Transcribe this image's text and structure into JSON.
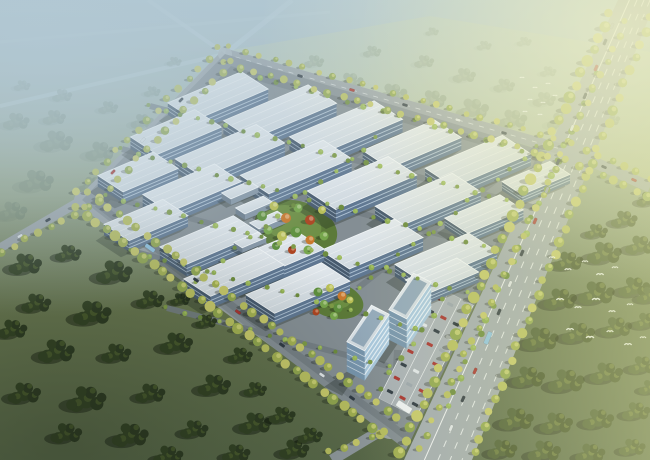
{
  "meta": {
    "title": "Industrial park aerial rendering",
    "description": "Bird's-eye architectural rendering: diamond-shaped industrial campus of white flat-roofed factory halls with blue-grey glass facades, central landscaped garden with orange and yellow accent trees, small warehouse sheds, two glass office towers beside a car park, tree-lined perimeter avenues with traffic, hazy blue mist upper-left, warm sunlit fields upper-right, dark green forests and grassland below, white birds flying over the woods.",
    "visible_text": "none"
  },
  "palette": {
    "mist": "#b2c7d3",
    "sky_warm": "#e9ebc8",
    "grass_dark": "#5c6b4a",
    "grass_mid": "#6d7c52",
    "grass_warm": "#8a9458",
    "forest_dark": "#2c3a22",
    "forest_mid": "#324224",
    "forest_hi": "#4b5e2e",
    "forest_warm": "#3f4e28",
    "forest_warm2": "#485932",
    "forest_warm_hi": "#6a793c",
    "haze_tree_a": "#7d8d66",
    "haze_tree_b": "#879471",
    "haze_tree_hi": "#9aa57d",
    "dist_tree_a": "#657763",
    "dist_tree_b": "#6e8069",
    "dist_tree_hi": "#7e8f74",
    "road": "#9aa3a8",
    "road_main": "#a2abb0",
    "road_inner": "#747e84",
    "marking": "#f4f8fa",
    "roof_light": "#eef2f5",
    "roof_shade": "#cbd5dc",
    "facade_long": "#5f7792",
    "facade_end": "#475a6e",
    "facade_stripe": "rgba(206,223,237,0.85)",
    "shed_long": "#8495a5",
    "shed_end": "#6b7c8c",
    "glass_long": "#a9c8de",
    "glass_end": "#7795ad",
    "glass_stripe": "rgba(246,251,253,0.9)",
    "tower_panel": "#93a9ba",
    "street_trees": [
      "#b8bf60",
      "#a2b052",
      "#c6c86a",
      "#90a64f"
    ],
    "street_tree_hi": "#d4d87e",
    "campus_trees": [
      "#7d9a46",
      "#8fae52",
      "#6d8c3e",
      "#9ab85a"
    ],
    "campus_tree_hi": "#a9c468",
    "garden": {
      "g1": "#5d8f3c",
      "g2": "#76a64c",
      "y": "#b9bf55",
      "o": "#c9792e",
      "r": "#ad4420",
      "base": "#5c7a39",
      "base_hi": "#76994a"
    },
    "car": {
      "red": "#a83430",
      "dark": "#2f3a44",
      "white": "#dfe5e9",
      "silver": "#9aa4ac",
      "bus": "#8fc3e2"
    },
    "shadow": "rgba(24,33,27,0.30)",
    "tree_shadow": "rgba(16,24,12,0.30)"
  },
  "scene": {
    "factories": [
      [
        218,
        96,
        80,
        32,
        12
      ],
      [
        280,
        112,
        92,
        34,
        13
      ],
      [
        346,
        128,
        92,
        34,
        13
      ],
      [
        412,
        144,
        78,
        32,
        12
      ],
      [
        478,
        161,
        84,
        34,
        12
      ],
      [
        536,
        178,
        52,
        24,
        9
      ],
      [
        176,
        132,
        70,
        32,
        12
      ],
      [
        230,
        151,
        88,
        34,
        13
      ],
      [
        296,
        167,
        90,
        34,
        13
      ],
      [
        362,
        183,
        88,
        34,
        13
      ],
      [
        428,
        199,
        84,
        34,
        12
      ],
      [
        484,
        214,
        60,
        28,
        10
      ],
      [
        138,
        172,
        60,
        30,
        11
      ],
      [
        192,
        188,
        78,
        32,
        12
      ],
      [
        372,
        244,
        80,
        34,
        13
      ],
      [
        446,
        258,
        80,
        34,
        12
      ],
      [
        146,
        220,
        64,
        30,
        11
      ],
      [
        210,
        240,
        80,
        32,
        12
      ],
      [
        274,
        256,
        80,
        32,
        12
      ],
      [
        442,
        276,
        56,
        26,
        10
      ],
      [
        234,
        272,
        80,
        32,
        12
      ],
      [
        298,
        288,
        82,
        34,
        12
      ]
    ],
    "sheds": [
      [
        240,
        190,
        30,
        11,
        6
      ],
      [
        254,
        205,
        30,
        11,
        6
      ],
      [
        268,
        220,
        30,
        11,
        6
      ],
      [
        250,
        240,
        26,
        10,
        5
      ]
    ],
    "towers": [
      [
        368,
        328,
        44,
        20,
        30
      ],
      [
        410,
        296,
        44,
        20,
        30
      ]
    ],
    "garden_trees": [
      [
        262,
        216,
        "g1",
        5
      ],
      [
        274,
        206,
        "y",
        4.5
      ],
      [
        286,
        218,
        "o",
        5
      ],
      [
        298,
        208,
        "g2",
        4.5
      ],
      [
        310,
        220,
        "r",
        5
      ],
      [
        322,
        210,
        "y",
        4
      ],
      [
        268,
        230,
        "g2",
        4.5
      ],
      [
        282,
        236,
        "y",
        5
      ],
      [
        296,
        232,
        "g1",
        5.5
      ],
      [
        310,
        240,
        "o",
        4.5
      ],
      [
        324,
        236,
        "g2",
        4.5
      ],
      [
        276,
        246,
        "g1",
        4
      ],
      [
        292,
        250,
        "r",
        4
      ],
      [
        308,
        250,
        "g2",
        4.5
      ],
      [
        318,
        292,
        "g1",
        4.5
      ],
      [
        330,
        288,
        "y",
        4
      ],
      [
        342,
        296,
        "o",
        4.5
      ],
      [
        324,
        304,
        "g2",
        4
      ],
      [
        338,
        308,
        "g1",
        4.5
      ],
      [
        350,
        300,
        "y",
        3.5
      ],
      [
        316,
        312,
        "r",
        3.5
      ],
      [
        334,
        316,
        "g2",
        4
      ]
    ],
    "parking": {
      "origin": [
        436,
        286
      ],
      "angle_row": 27,
      "angle_aisle": 117,
      "width": 42,
      "length": 126,
      "rows": 3,
      "row_step": 14,
      "cols": 8,
      "col_step": 15,
      "car_size": [
        6.4,
        3.1
      ],
      "car_colors": [
        "red",
        "dark",
        "white",
        "silver",
        "red",
        "dark"
      ]
    },
    "tree_rows_street": [
      [
        610,
        14,
        400,
        452,
        13,
        4.2,
        6.2
      ],
      [
        626,
        22,
        420,
        448,
        15,
        3.0,
        4.0
      ],
      [
        651,
        18,
        474,
        452,
        14,
        3.8,
        5.4
      ],
      [
        230,
        47,
        569,
        142,
        15,
        2.6,
        3.6
      ],
      [
        225,
        63,
        563,
        160,
        15,
        3.0,
        4.2
      ],
      [
        219,
        48,
        76,
        192,
        14,
        3.0,
        4.2
      ],
      [
        232,
        62,
        90,
        208,
        14,
        3.2,
        4.4
      ],
      [
        77,
        208,
        381,
        434,
        12,
        4.0,
        5.8
      ],
      [
        89,
        193,
        397,
        417,
        12,
        3.6,
        5.0
      ],
      [
        86,
        208,
        2,
        252,
        13,
        3.2,
        4.4
      ],
      [
        573,
        144,
        650,
        178,
        13,
        3.2,
        4.4
      ],
      [
        567,
        160,
        648,
        196,
        13,
        3.4,
        4.8
      ],
      [
        330,
        452,
        384,
        432,
        14,
        3.2,
        4.2
      ]
    ],
    "tree_rows_campus": [
      [
        150,
        106,
        536,
        208,
        16,
        2.0,
        3.0
      ],
      [
        122,
        149,
        498,
        250,
        16,
        2.0,
        3.0
      ],
      [
        107,
        196,
        466,
        292,
        16,
        2.0,
        3.0
      ],
      [
        132,
        251,
        416,
        328,
        17,
        2.0,
        2.8
      ],
      [
        167,
        308,
        388,
        366,
        17,
        2.0,
        2.8
      ],
      [
        377,
        138,
        194,
        282,
        18,
        2.0,
        2.8
      ],
      [
        538,
        147,
        358,
        288,
        18,
        2.0,
        2.8
      ],
      [
        598,
        74,
        447,
        406,
        16,
        2.6,
        3.8
      ],
      [
        242,
        72,
        556,
        160,
        18,
        2.2,
        3.2
      ],
      [
        444,
        300,
        380,
        388,
        18,
        2.4,
        3.2
      ]
    ],
    "forest_bottom_left": [
      [
        25,
        265,
        1
      ],
      [
        68,
        254,
        0.8
      ],
      [
        114,
        273,
        1.1
      ],
      [
        36,
        304,
        0.9
      ],
      [
        92,
        314,
        1.15
      ],
      [
        150,
        300,
        0.85
      ],
      [
        56,
        352,
        1.1
      ],
      [
        116,
        354,
        0.9
      ],
      [
        176,
        344,
        1
      ],
      [
        24,
        394,
        1
      ],
      [
        86,
        400,
        1.2
      ],
      [
        150,
        394,
        0.9
      ],
      [
        214,
        386,
        1
      ],
      [
        66,
        434,
        0.95
      ],
      [
        130,
        436,
        1.1
      ],
      [
        194,
        430,
        0.85
      ],
      [
        255,
        424,
        1
      ],
      [
        168,
        456,
        0.9
      ],
      [
        236,
        454,
        0.85
      ],
      [
        294,
        450,
        0.9
      ],
      [
        240,
        356,
        0.75
      ],
      [
        206,
        322,
        0.65
      ],
      [
        282,
        416,
        0.8
      ],
      [
        310,
        436,
        0.75
      ],
      [
        12,
        330,
        0.9
      ],
      [
        180,
        300,
        0.6
      ],
      [
        255,
        390,
        0.7
      ]
    ],
    "forest_right": [
      [
        568,
        262,
        0.9
      ],
      [
        604,
        254,
        1.05
      ],
      [
        640,
        246,
        0.9
      ],
      [
        560,
        300,
        1
      ],
      [
        596,
        294,
        1.1
      ],
      [
        634,
        288,
        0.95
      ],
      [
        540,
        340,
        1.1
      ],
      [
        578,
        334,
        1
      ],
      [
        616,
        328,
        0.95
      ],
      [
        646,
        322,
        0.8
      ],
      [
        528,
        378,
        1
      ],
      [
        566,
        382,
        1.1
      ],
      [
        606,
        374,
        1
      ],
      [
        642,
        366,
        0.85
      ],
      [
        516,
        420,
        1.05
      ],
      [
        556,
        424,
        1
      ],
      [
        598,
        420,
        0.95
      ],
      [
        636,
        412,
        0.85
      ],
      [
        502,
        450,
        0.9
      ],
      [
        544,
        452,
        1
      ],
      [
        590,
        454,
        0.9
      ],
      [
        632,
        448,
        0.8
      ],
      [
        648,
        200,
        0.7
      ],
      [
        624,
        220,
        0.8
      ],
      [
        596,
        232,
        0.7
      ],
      [
        650,
        296,
        0.8
      ],
      [
        650,
        388,
        0.7
      ]
    ],
    "trees_top_right": [
      [
        350,
        82,
        0.8
      ],
      [
        392,
        94,
        0.9
      ],
      [
        432,
        100,
        0.85
      ],
      [
        472,
        110,
        1
      ],
      [
        512,
        120,
        0.9
      ],
      [
        314,
        62,
        0.6
      ],
      [
        372,
        52,
        0.55
      ],
      [
        424,
        62,
        0.6
      ],
      [
        464,
        76,
        0.7
      ],
      [
        504,
        86,
        0.65
      ],
      [
        544,
        100,
        0.7
      ],
      [
        548,
        72,
        0.5
      ],
      [
        484,
        46,
        0.45
      ],
      [
        432,
        32,
        0.4
      ],
      [
        524,
        42,
        0.45
      ],
      [
        560,
        122,
        0.8
      ],
      [
        588,
        90,
        0.5
      ],
      [
        610,
        120,
        0.6
      ]
    ],
    "trees_top_left": [
      [
        16,
        122,
        0.8
      ],
      [
        56,
        142,
        1
      ],
      [
        100,
        152,
        0.9
      ],
      [
        36,
        182,
        1.05
      ],
      [
        92,
        186,
        0.8
      ],
      [
        12,
        212,
        0.9
      ],
      [
        142,
        122,
        0.7
      ],
      [
        62,
        96,
        0.6
      ],
      [
        22,
        86,
        0.5
      ],
      [
        122,
        176,
        0.6
      ],
      [
        152,
        92,
        0.5
      ],
      [
        174,
        62,
        0.45
      ],
      [
        108,
        108,
        0.6
      ],
      [
        54,
        118,
        0.7
      ]
    ],
    "vehicles": [
      [
        612,
        26,
        113,
        "silver",
        6,
        2.8
      ],
      [
        605,
        42,
        113,
        "dark",
        6.5,
        3
      ],
      [
        596,
        68,
        113,
        "red",
        6.5,
        3
      ],
      [
        585,
        96,
        113,
        "dark",
        6.5,
        3
      ],
      [
        572,
        128,
        113,
        "white",
        6.5,
        3
      ],
      [
        558,
        162,
        113,
        "dark",
        6.5,
        3
      ],
      [
        547,
        190,
        113,
        "silver",
        6.5,
        3
      ],
      [
        535,
        221,
        113,
        "red",
        6.5,
        3
      ],
      [
        522,
        253,
        113,
        "dark",
        6.5,
        3
      ],
      [
        510,
        284,
        113,
        "white",
        6.5,
        3
      ],
      [
        499,
        312,
        113,
        "dark",
        6.5,
        3
      ],
      [
        488,
        338,
        113,
        "bus",
        13,
        4.6
      ],
      [
        475,
        371,
        113,
        "red",
        6.5,
        3
      ],
      [
        463,
        399,
        113,
        "dark",
        6.5,
        3
      ],
      [
        451,
        428,
        113,
        "white",
        6.5,
        3
      ],
      [
        300,
        76,
        16,
        "dark",
        5.5,
        2.6
      ],
      [
        352,
        90,
        16,
        "red",
        5.5,
        2.6
      ],
      [
        405,
        105,
        16,
        "dark",
        5.5,
        2.6
      ],
      [
        458,
        120,
        16,
        "white",
        5.5,
        2.6
      ],
      [
        504,
        133,
        16,
        "dark",
        5.5,
        2.6
      ],
      [
        181,
        100,
        134,
        "dark",
        5.5,
        2.6
      ],
      [
        143,
        140,
        134,
        "white",
        5.5,
        2.6
      ],
      [
        113,
        172,
        134,
        "red",
        5.5,
        2.6
      ],
      [
        150,
        248,
        36,
        "bus",
        11,
        4
      ],
      [
        196,
        280,
        36,
        "dark",
        6,
        2.8
      ],
      [
        238,
        312,
        36,
        "red",
        6,
        2.8
      ],
      [
        282,
        345,
        36,
        "dark",
        6,
        2.8
      ],
      [
        322,
        375,
        36,
        "white",
        6,
        2.8
      ],
      [
        352,
        398,
        36,
        "dark",
        6,
        2.8
      ],
      [
        48,
        220,
        150,
        "dark",
        5.5,
        2.6
      ],
      [
        20,
        236,
        150,
        "white",
        5.5,
        2.6
      ],
      [
        604,
        167,
        24,
        "dark",
        5.5,
        2.6
      ],
      [
        634,
        180,
        24,
        "red",
        5.5,
        2.6
      ]
    ],
    "birds": {
      "flock_small": [
        [
          522,
          78
        ],
        [
          535,
          88
        ],
        [
          548,
          84
        ],
        [
          530,
          100
        ],
        [
          543,
          103
        ],
        [
          555,
          96
        ],
        [
          525,
          112
        ],
        [
          540,
          115
        ]
      ],
      "flock_large": [
        [
          552,
          258,
          1
        ],
        [
          568,
          270,
          1.1
        ],
        [
          585,
          262,
          1
        ],
        [
          600,
          275,
          1.2
        ],
        [
          615,
          268,
          1
        ],
        [
          560,
          300,
          1.2
        ],
        [
          578,
          308,
          1.1
        ],
        [
          596,
          300,
          1.3
        ],
        [
          612,
          312,
          1.1
        ],
        [
          630,
          305,
          1
        ],
        [
          570,
          330,
          1.2
        ],
        [
          590,
          338,
          1.3
        ],
        [
          610,
          332,
          1.1
        ],
        [
          628,
          345,
          1.2
        ],
        [
          643,
          338,
          1
        ]
      ]
    }
  }
}
